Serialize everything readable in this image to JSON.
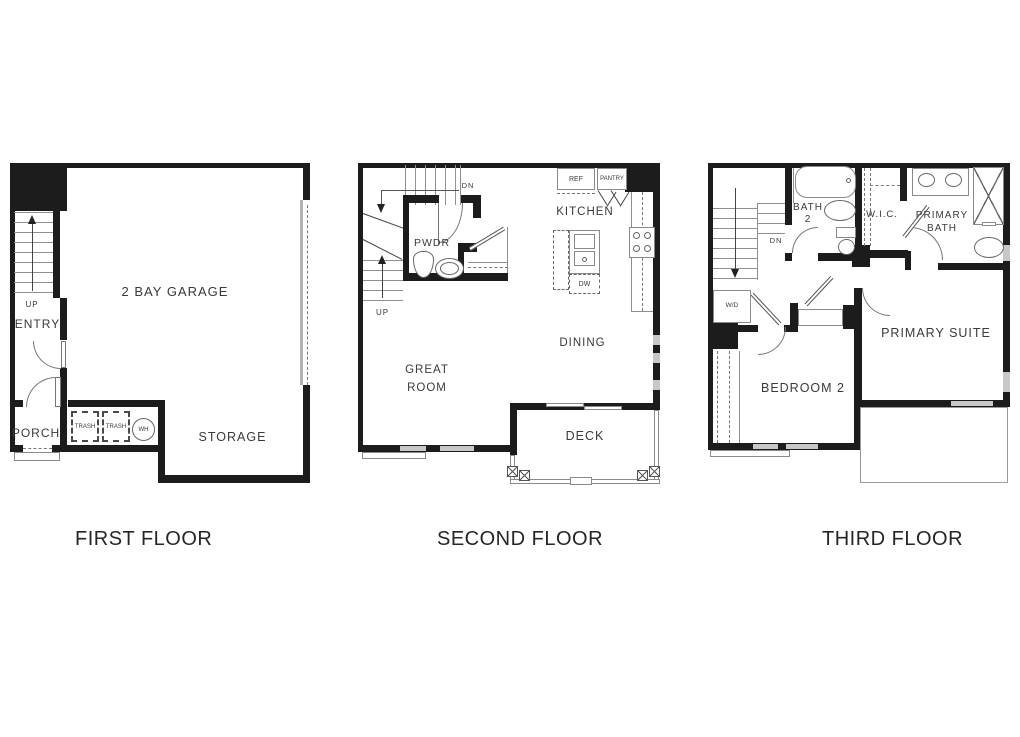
{
  "colors": {
    "wall": "#1c1c1c",
    "line": "#8f8f8f",
    "dash": "#777777",
    "text": "#3a3a3a",
    "window": "#c8c8c8",
    "background": "#ffffff"
  },
  "floors": [
    {
      "title": "FIRST FLOOR",
      "labels": {
        "garage": "2 BAY GARAGE",
        "entry": "ENTRY",
        "up": "UP",
        "porch": "PORCH",
        "trash": "TRASH",
        "wh": "WH",
        "storage": "STORAGE"
      }
    },
    {
      "title": "SECOND FLOOR",
      "labels": {
        "dn": "DN",
        "up": "UP",
        "pwdr": "PWDR",
        "kitchen": "KITCHEN",
        "ref": "REF",
        "pantry": "PANTRY",
        "dw": "DW",
        "dining": "DINING",
        "great1": "GREAT",
        "great2": "ROOM",
        "deck": "DECK"
      }
    },
    {
      "title": "THIRD FLOOR",
      "labels": {
        "dn": "DN",
        "bath2a": "BATH",
        "bath2b": "2",
        "wic": "W.I.C.",
        "pbath1": "PRIMARY",
        "pbath2": "BATH",
        "wd": "W/D",
        "bedroom2": "BEDROOM 2",
        "suite": "PRIMARY SUITE"
      }
    }
  ]
}
